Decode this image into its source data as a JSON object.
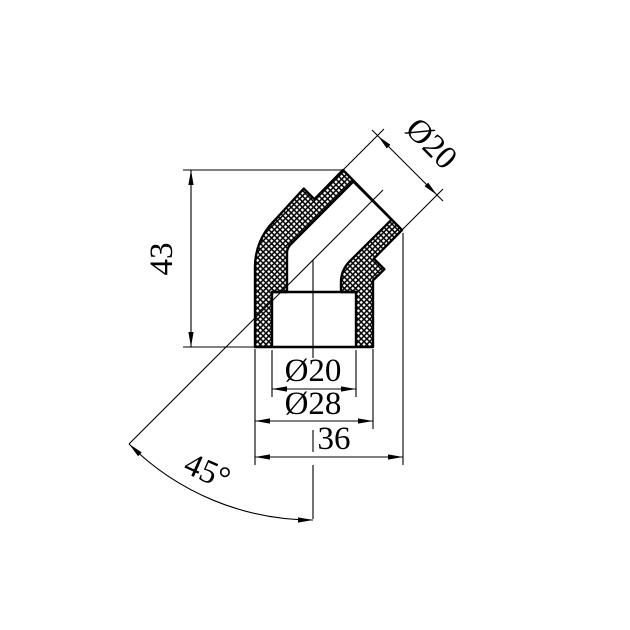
{
  "drawing": {
    "description": "Cross-section technical drawing of a 45-degree elbow pipe fitting with crosshatched cut walls and dimension annotations",
    "colors": {
      "background": "#ffffff",
      "line": "#000000"
    },
    "dimensions": {
      "height": {
        "label": "43"
      },
      "branch_outer_diameter": {
        "label": "Ø20"
      },
      "socket_bore_diameter": {
        "label": "Ø20"
      },
      "socket_outer_diameter": {
        "label": "Ø28"
      },
      "overall_width": {
        "label": "36"
      },
      "bend_angle": {
        "label": "45°"
      }
    }
  }
}
